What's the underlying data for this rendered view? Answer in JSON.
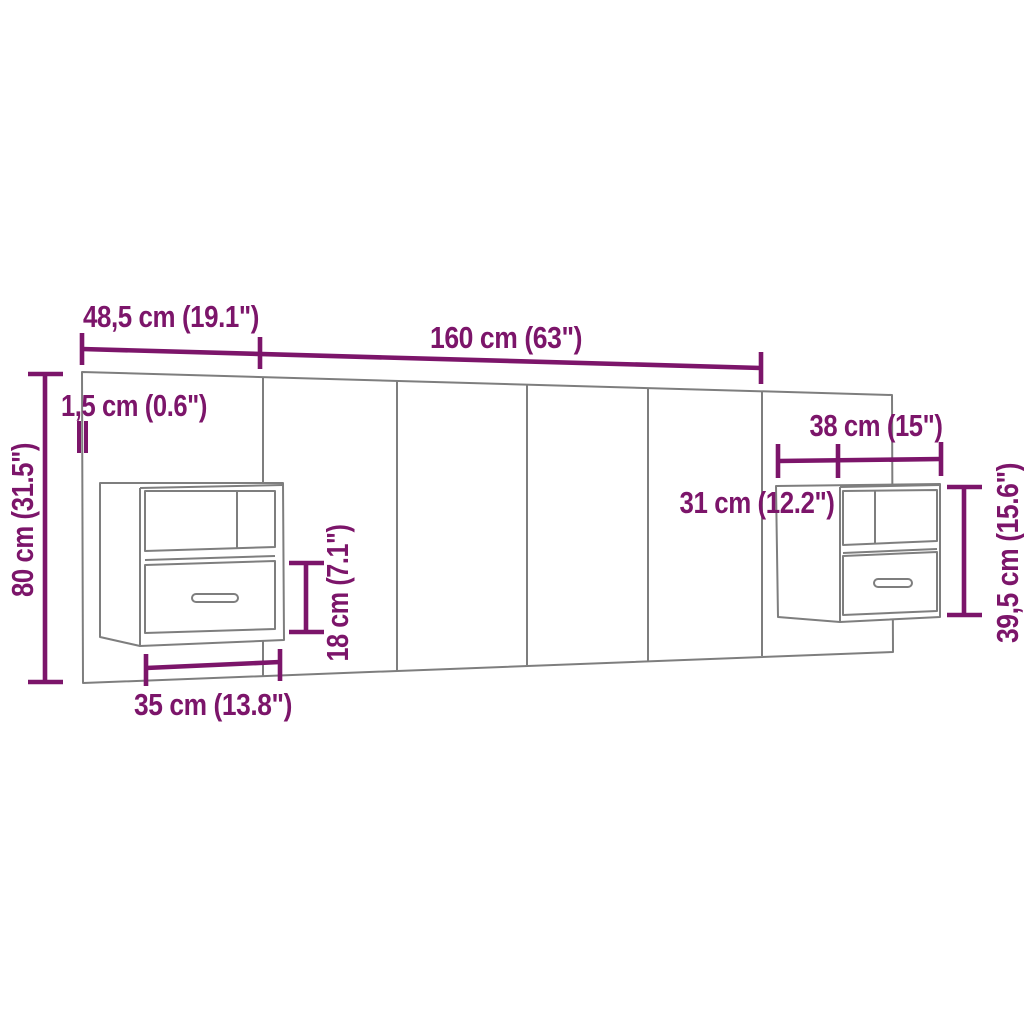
{
  "diagram": {
    "kind": "furniture-dimension-diagram",
    "subject": "headboard-with-two-wall-cabinets",
    "colors": {
      "dimension_accent": "#7C156A",
      "product_outline": "#7E7E7E",
      "background": "#FFFFFF"
    },
    "labels": {
      "ext_panel_width": "48,5 cm (19.1\")",
      "main_panel_width": "160 cm (63\")",
      "panel_thickness": "1,5 cm (0.6\")",
      "panel_height": "80 cm (31.5\")",
      "right_cabinet_width": "38 cm (15\")",
      "right_cabinet_depth": "31 cm (12.2\")",
      "right_cabinet_height": "39,5 cm (15.6\")",
      "left_drawer_height": "18 cm (7.1\")",
      "left_cabinet_width": "35 cm (13.8\")"
    }
  }
}
